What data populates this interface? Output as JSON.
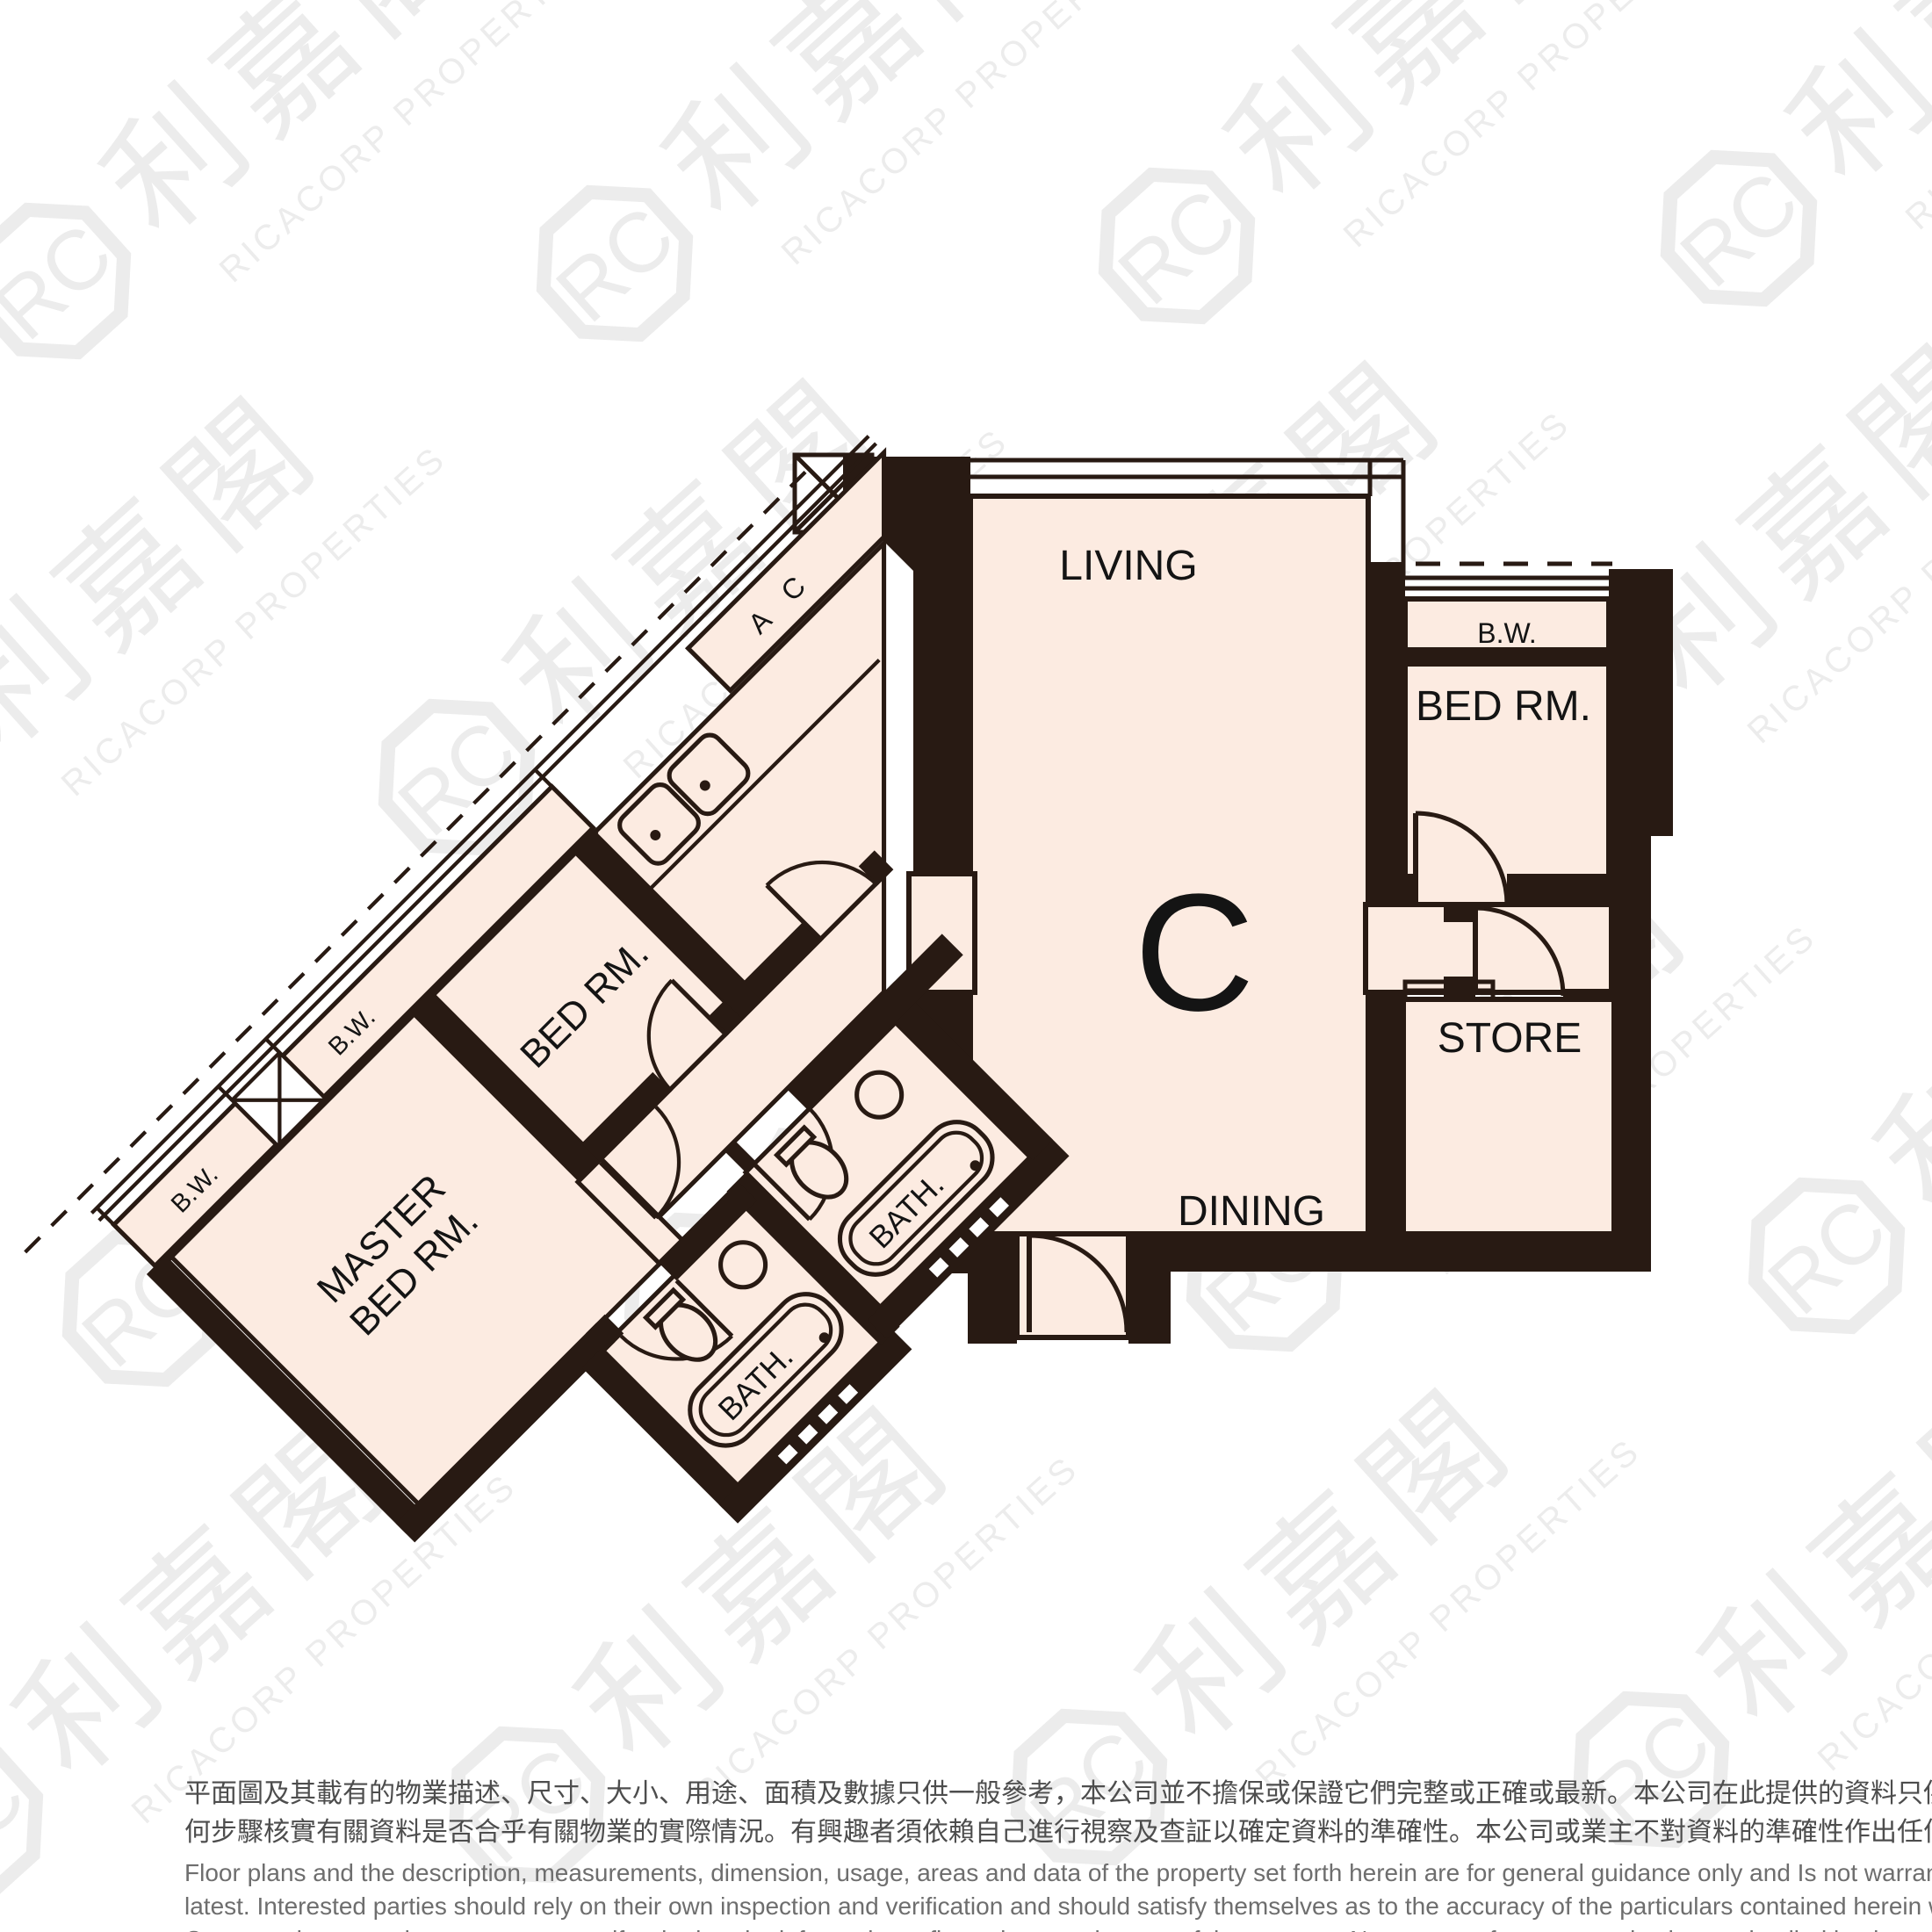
{
  "unit": {
    "label": "C"
  },
  "rooms": {
    "living": "LIVING",
    "dining": "DINING",
    "kitchen": "KIT.",
    "bedroom_annex": "BED RM.",
    "bedroom_wing": "BED RM.",
    "master_bedroom": {
      "line1": "MASTER",
      "line2": "BED RM."
    },
    "store": "STORE",
    "bath1": "BATH.",
    "bath2": "BATH.",
    "bw_annex": "B.W.",
    "bw_bed2": "B.W.",
    "bw_master": "B.W.",
    "ac_platform": "A C"
  },
  "watermark": {
    "logo_text": "RC",
    "cn_text": "利嘉閣",
    "en_text": "RICACORP PROPERTIES"
  },
  "colors": {
    "floor": "#fcebe1",
    "wall": "#281a13",
    "watermark": "#eaeaea",
    "background": "#ffffff"
  },
  "disclaimer": {
    "cn_line1": "平面圖及其載有的物業描述、尺寸、大小、用途、面積及數據只供一般參考，本公司並不擔保或保證它們完整或正確或最新。本公司在此提供的資料只供閣下參考，本公司並無採取任",
    "cn_line2": "何步驟核實有關資料是否合乎有關物業的實際情況。有興趣者須依賴自己進行視察及查証以確定資料的準確性。本公司或業主不對資料的準確性作出任何明示或隱含的保證。",
    "en_line1": "Floor plans and the description, measurements, dimension, usage, areas and data of the property set forth herein are for general guidance only and Is not warranted or guaranteed to be complete or correct or the",
    "en_line2": "latest. Interested parties should rely on their own inspection and verification and should satisfy themselves as to the accuracy of the particulars contained herein which are provided by us for information only.  Our",
    "en_line3": "Company has not taken any step to verify whether the information reflects the actual status of the property.  No warranty for accuracy is given or implied by the owners or us."
  }
}
